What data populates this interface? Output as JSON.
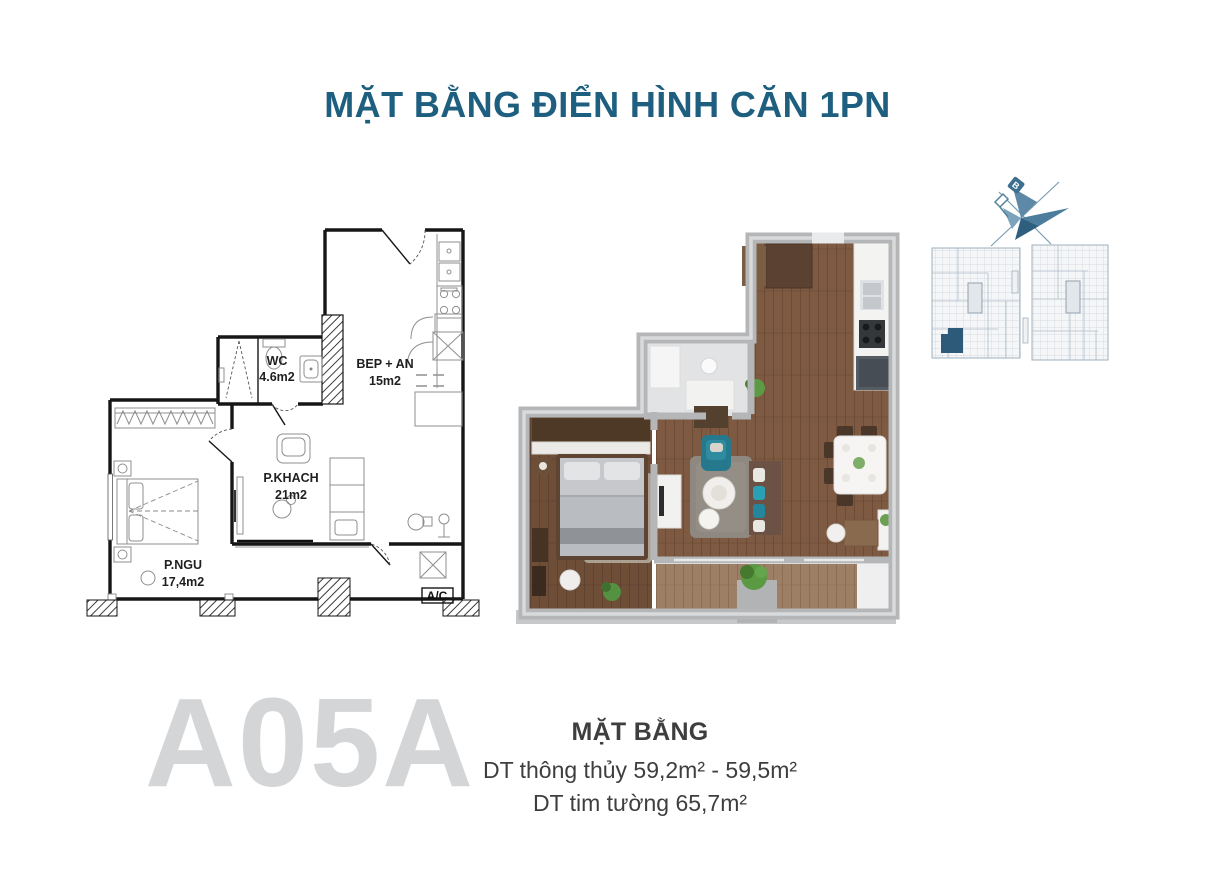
{
  "page": {
    "title": "MẶT BẰNG ĐIỂN HÌNH CĂN 1PN"
  },
  "plan2d": {
    "rooms": [
      {
        "id": "wc",
        "name": "WC",
        "area": "4.6m2"
      },
      {
        "id": "kitchen",
        "name": "BEP + AN",
        "area": "15m2"
      },
      {
        "id": "living",
        "name": "P.KHACH",
        "area": "21m2"
      },
      {
        "id": "bedroom",
        "name": "P.NGU",
        "area": "17,4m2"
      }
    ],
    "ac_label": "A/C"
  },
  "compass": {
    "north_label": "B"
  },
  "unit": {
    "code": "A05A",
    "heading": "MẶT BẰNG",
    "area_line1": "DT thông thủy 59,2m² - 59,5m²",
    "area_line2": "DT tim tường 65,7m²"
  },
  "colors": {
    "title": "#1e5f80",
    "body_text": "#3e3e3e",
    "unit_code": "#d3d5d7",
    "compass_blue": "#4d7d9c",
    "keyplan_highlight": "#2d5a78",
    "wall_gray_3d": "#b4b6b8",
    "wood_floor_3d": "#7d5a41",
    "accent_teal_3d": "#26798c"
  }
}
